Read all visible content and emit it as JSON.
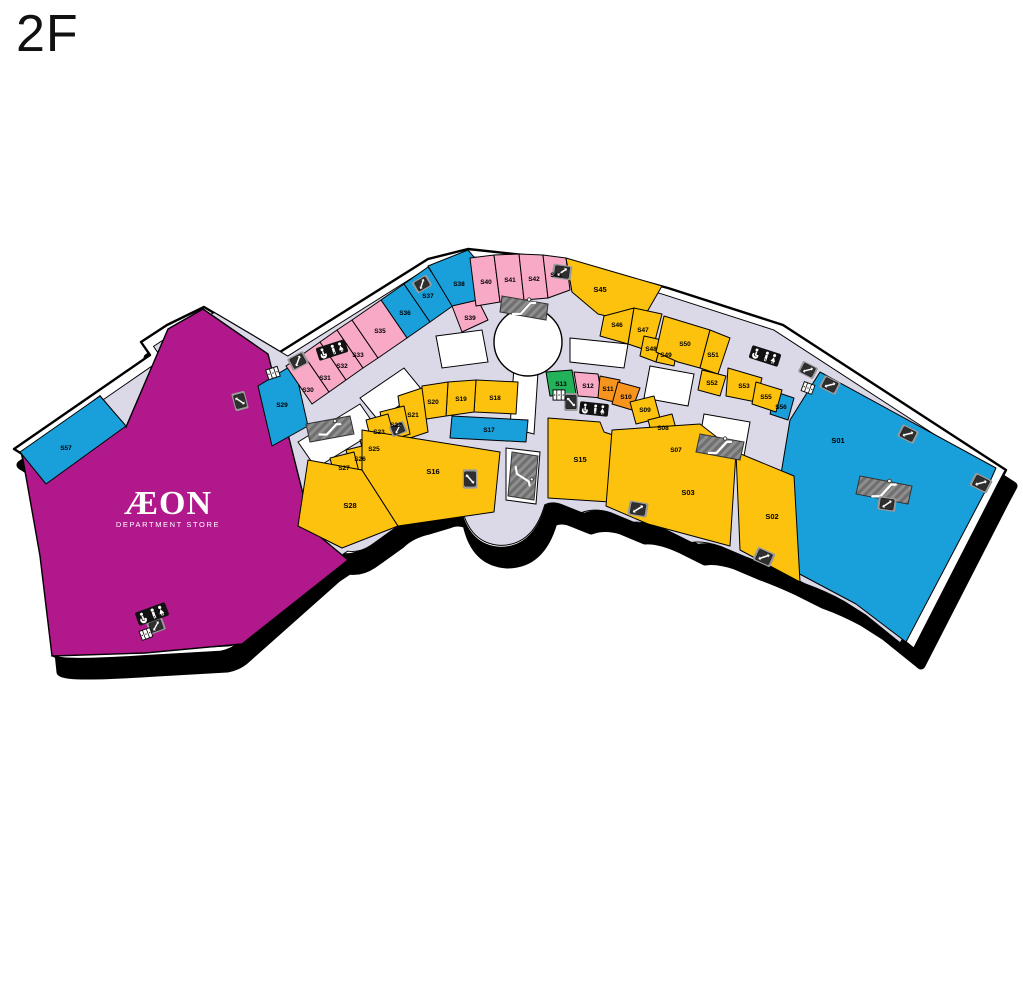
{
  "floor": "2F",
  "anchor_store": {
    "name": "ÆON",
    "subtitle": "DEPARTMENT STORE"
  },
  "colors": {
    "shop_yellow": "#FCC20E",
    "shop_blue": "#199FD9",
    "shop_pink": "#F8A9C6",
    "shop_orange": "#F7941E",
    "shop_green": "#22B25A",
    "anchor_magenta": "#B0188C",
    "corridor": "#DBD8E8",
    "vacant": "#FFFFFF",
    "building": "#FFFFFF",
    "outline": "#000000",
    "icon_dark": "#3B3B3B",
    "icon_gray": "#8E8E8E"
  },
  "icons": {
    "elevator": "elevator",
    "escalator": "escalator",
    "restroom": "restroom-wheelchair-wc",
    "lockers": "coin-lockers"
  },
  "units": {
    "s01": "S01",
    "s02": "S02",
    "s03": "S03",
    "s07": "S07",
    "s08": "S08",
    "s09": "S09",
    "s10": "S10",
    "s11": "S11",
    "s12": "S12",
    "s13": "S13",
    "s15": "S15",
    "s16": "S16",
    "s17": "S17",
    "s18": "S18",
    "s19": "S19",
    "s20": "S20",
    "s21": "S21",
    "s22": "S22",
    "s23": "S23",
    "s25": "S25",
    "s26": "S26",
    "s27": "S27",
    "s28": "S28",
    "s29": "S29",
    "s30": "S30",
    "s31": "S31",
    "s32": "S32",
    "s33": "S33",
    "s35": "S35",
    "s36": "S36",
    "s37": "S37",
    "s38": "S38",
    "s39": "S39",
    "s40": "S40",
    "s41": "S41",
    "s42": "S42",
    "s43": "S43",
    "s45": "S45",
    "s46": "S46",
    "s47": "S47",
    "s48": "S48",
    "s49": "S49",
    "s50": "S50",
    "s51": "S51",
    "s52": "S52",
    "s53": "S53",
    "s55": "S55",
    "s56": "S56",
    "s57": "S57"
  }
}
